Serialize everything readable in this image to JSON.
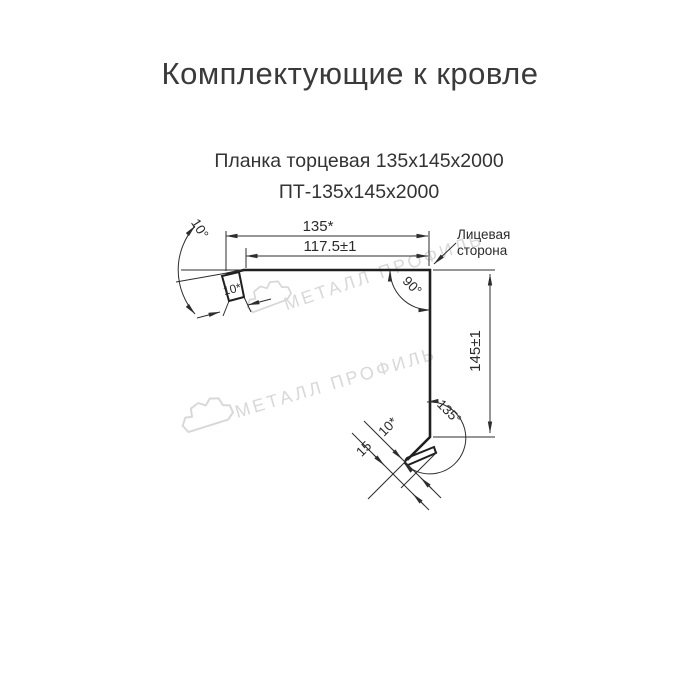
{
  "page": {
    "title": "Комплектующие к кровле"
  },
  "product": {
    "name": "Планка торцевая 135х145х2000",
    "sku": "ПТ-135х145х2000"
  },
  "drawing": {
    "dimensions": {
      "total_width": "135*",
      "inner_width": "117.5±1",
      "height": "145±1",
      "left_hem": "10*",
      "bottom_flange": "15",
      "bottom_hem": "10*"
    },
    "angles": {
      "top_left": "10°",
      "corner": "90°",
      "bottom": "135°"
    },
    "annotations": {
      "face_side_line1": "Лицевая",
      "face_side_line2": "сторона"
    },
    "colors": {
      "profile_line": "#1f1f1f",
      "dimension_line": "#2d2d2d",
      "watermark": "#d8d8d8"
    }
  },
  "watermark": {
    "text": "МЕТАЛЛ ПРОФИЛЬ",
    "logo": "cloud-outline-icon"
  }
}
